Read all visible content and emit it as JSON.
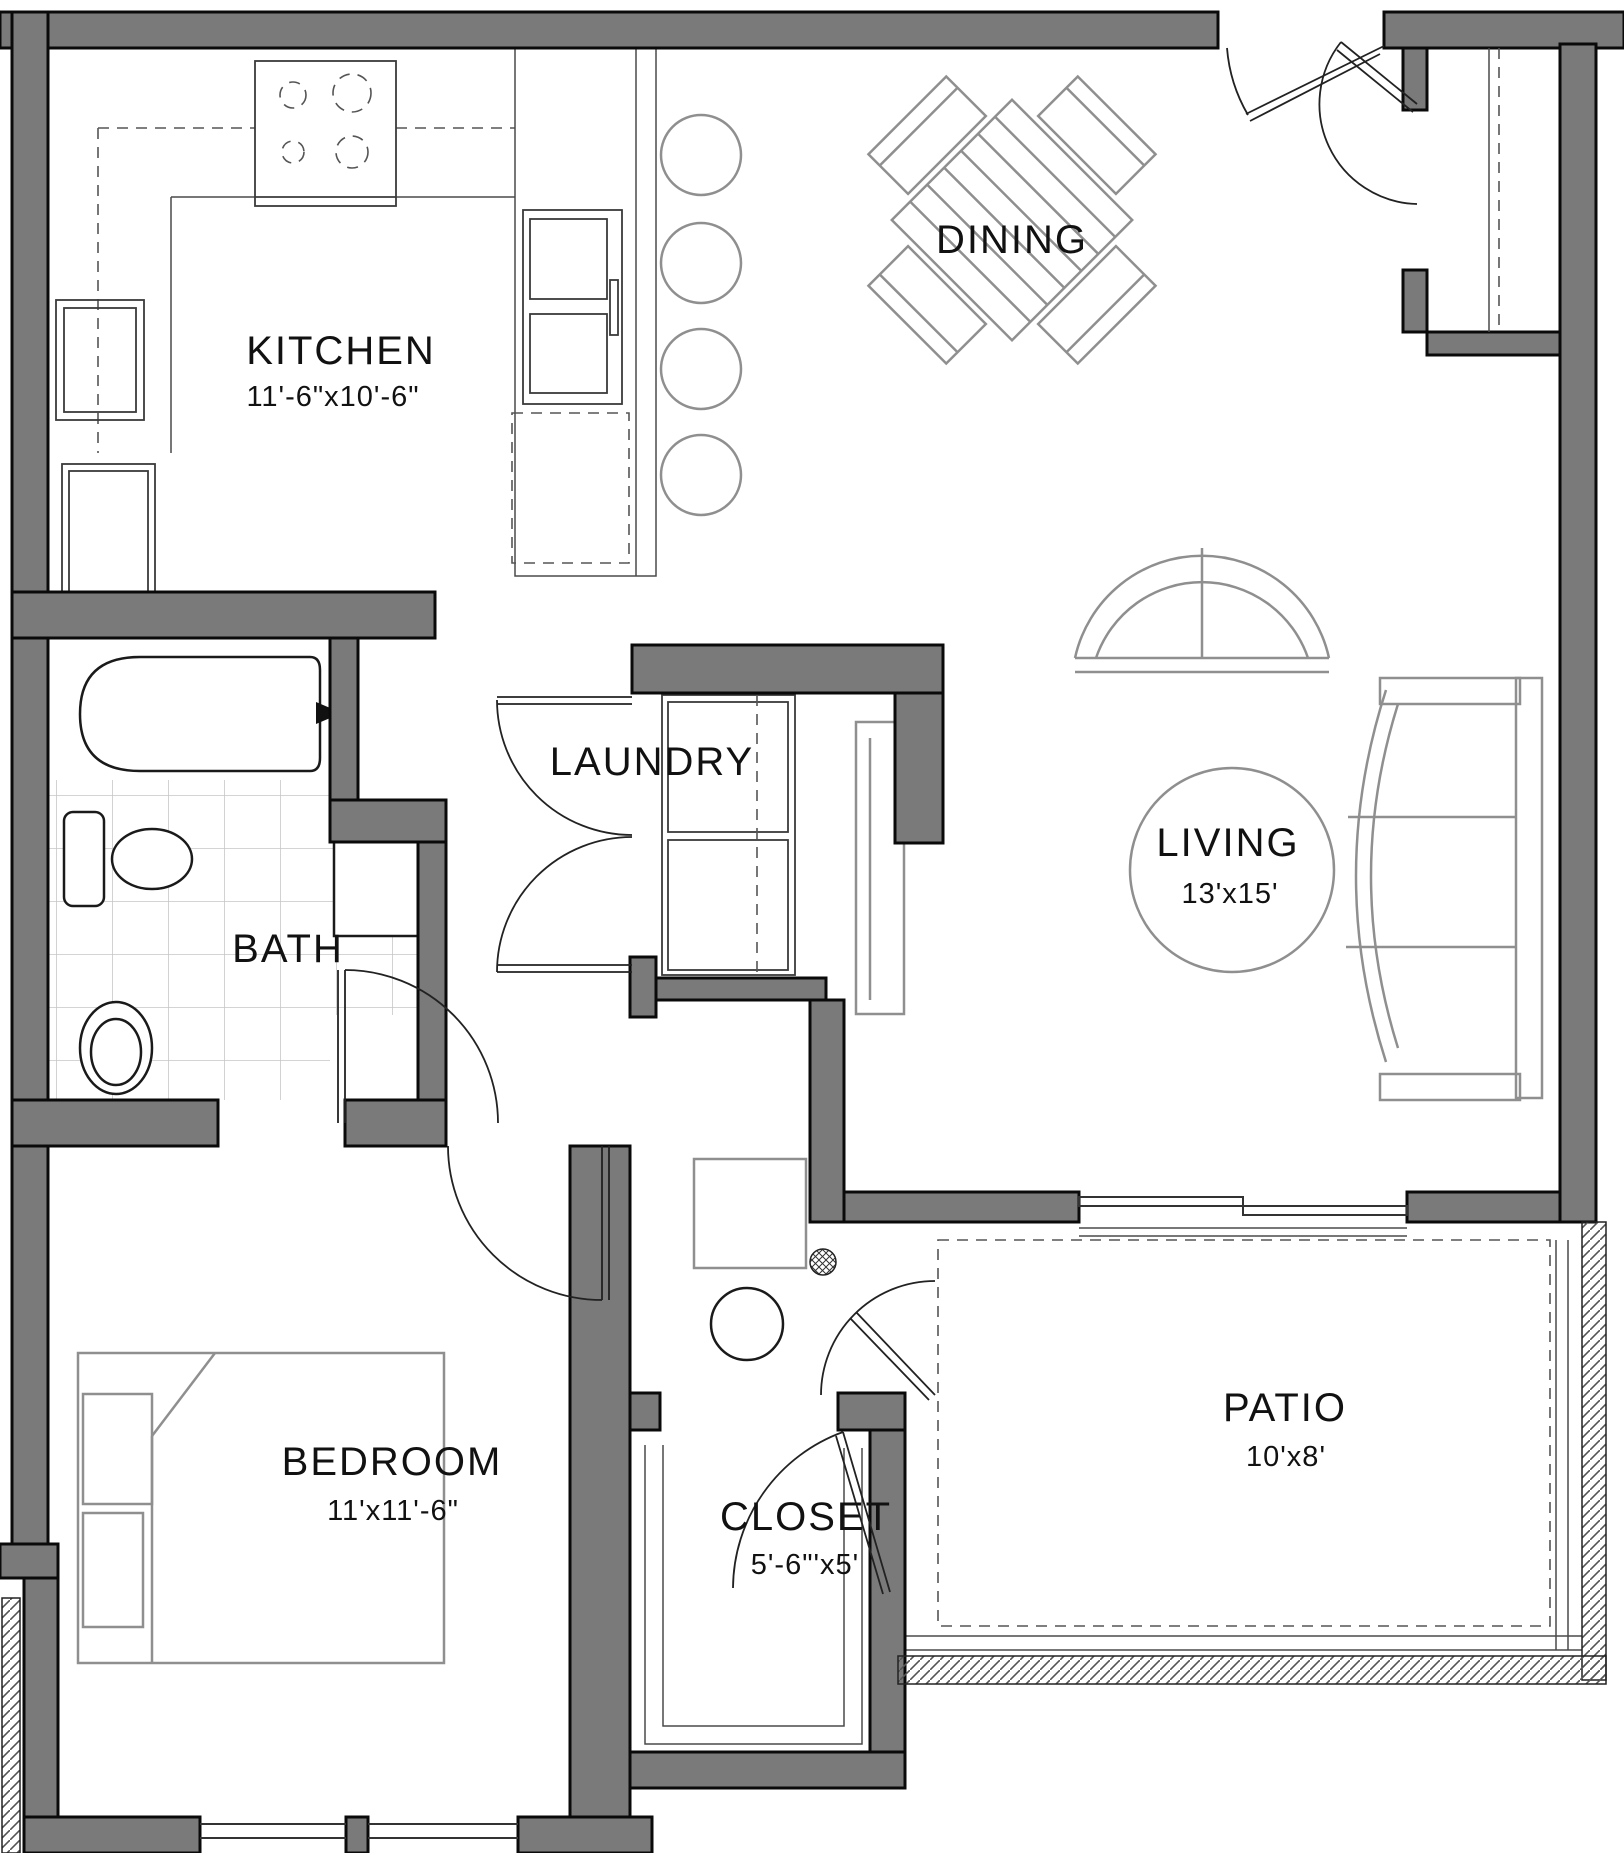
{
  "plan": {
    "title": "One-bedroom apartment floor plan",
    "colors": {
      "wall_fill": "#7a7a7a",
      "wall_outline": "#0a0a0a",
      "furniture_line": "#8f8f8f",
      "fixture_line": "#1a1a1a",
      "tile_line": "#c6c6c6",
      "background": "#ffffff",
      "text": "#111111"
    },
    "rooms": [
      {
        "id": "kitchen",
        "label": "KITCHEN",
        "dims": "11'-6\"x10'-6\""
      },
      {
        "id": "dining",
        "label": "DINING"
      },
      {
        "id": "living",
        "label": "LIVING",
        "dims": "13'x15'"
      },
      {
        "id": "bath",
        "label": "BATH"
      },
      {
        "id": "laundry",
        "label": "LAUNDRY"
      },
      {
        "id": "bedroom",
        "label": "BEDROOM",
        "dims": "11'x11'-6\""
      },
      {
        "id": "closet",
        "label": "CLOSET",
        "dims": "5'-6\"'x5'"
      },
      {
        "id": "patio",
        "label": "PATIO",
        "dims": "10'x8'"
      }
    ],
    "fixtures": [
      "range-cooktop",
      "kitchen-sink",
      "dishwasher",
      "refrigerator",
      "pantry-cabinet",
      "breakfast-bar",
      "bar-stools",
      "dining-table",
      "dining-chairs",
      "area-rug",
      "arched-window",
      "sofa",
      "console-table",
      "bathtub",
      "tub-faucet",
      "toilet",
      "bath-sink",
      "linen-cabinet",
      "tile-floor",
      "washer-dryer",
      "furnace",
      "floor-drain",
      "water-heater",
      "bed",
      "closet-shelving",
      "entry-door",
      "coat-closet-rod",
      "sliding-glass-door",
      "bedroom-windows",
      "patio-slab"
    ]
  }
}
